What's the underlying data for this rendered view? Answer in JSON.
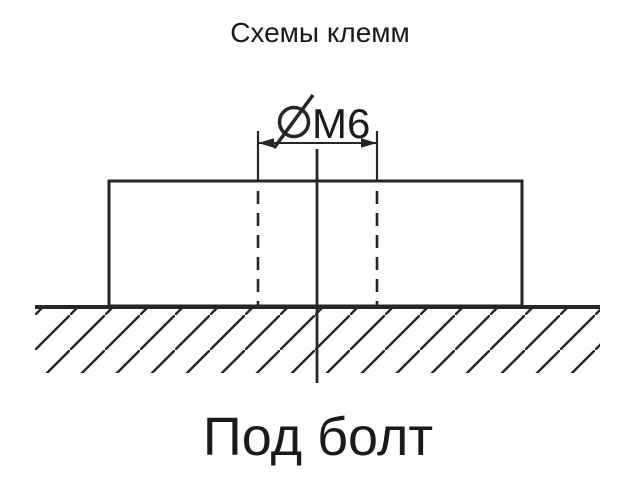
{
  "colors": {
    "background": "#ffffff",
    "line": "#262626",
    "text": "#1a1a1a"
  },
  "title": "Схемы клемм",
  "diagram": {
    "dimension_symbol": "⌀",
    "dimension_label": "M6",
    "caption": "Под болт"
  }
}
